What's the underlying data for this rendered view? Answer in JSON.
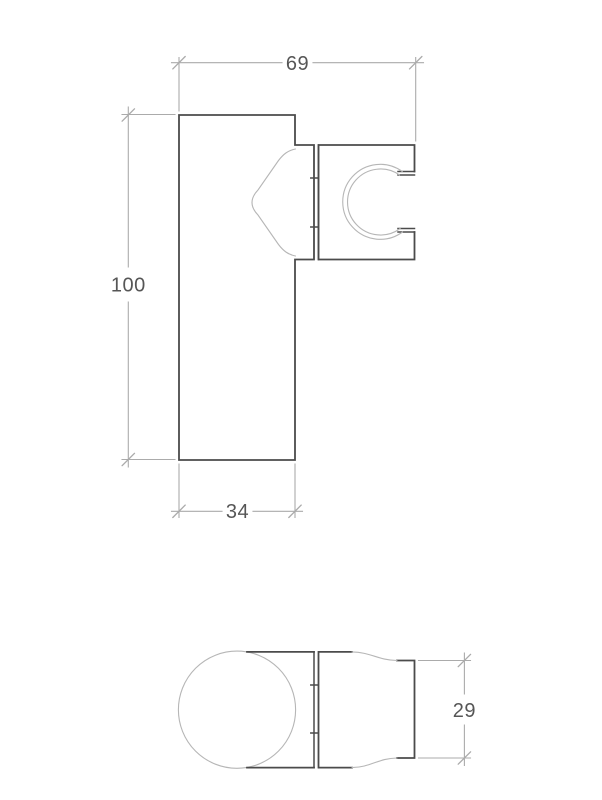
{
  "drawing": {
    "colors": {
      "outline": "#4b4b4b",
      "thin_line": "#b6b6b6",
      "dim_line": "#ababab",
      "dim_text": "#565656",
      "background": "#ffffff"
    },
    "side_view": {
      "dim_total_width": "69",
      "dim_total_height": "100",
      "dim_plate_width": "34"
    },
    "plan_view": {
      "dim_holder_width": "29"
    }
  }
}
